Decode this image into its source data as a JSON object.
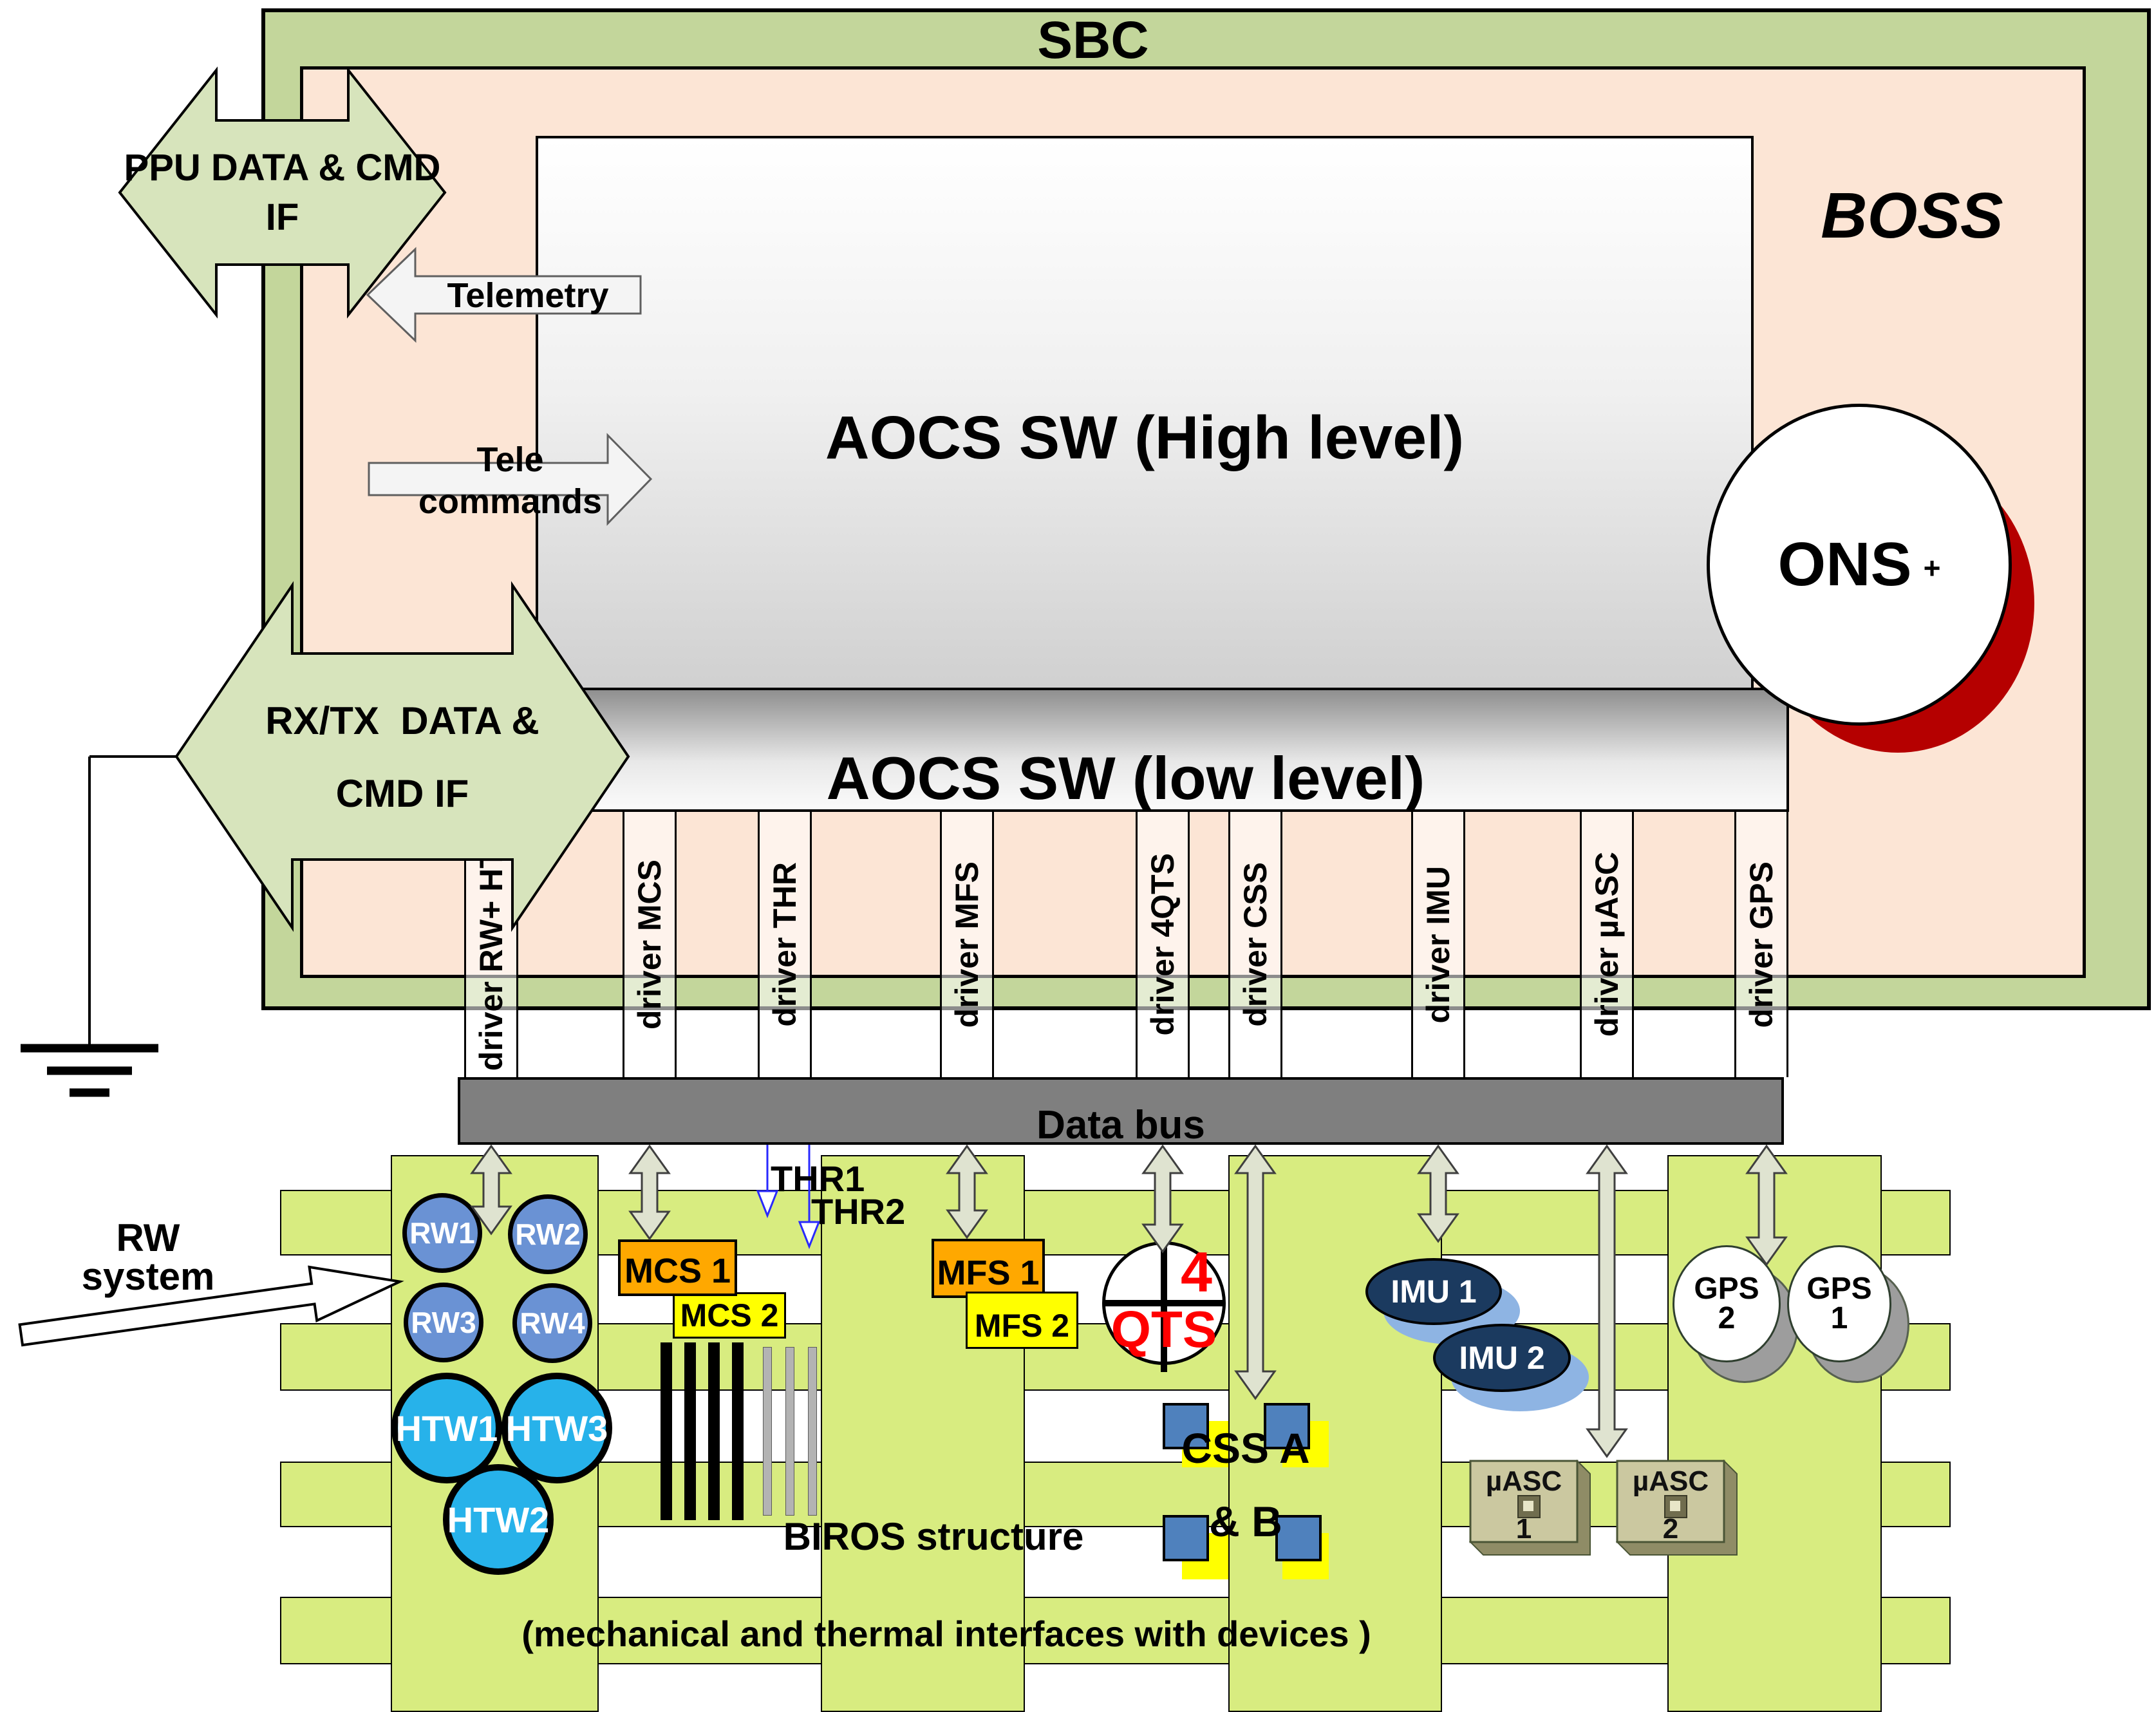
{
  "titles": {
    "sbc": "SBC",
    "boss": "BOSS"
  },
  "software": {
    "high_level": "AOCS SW (High level)",
    "low_level": "AOCS SW (low level)",
    "ons": "ONS",
    "ons_plus": "+"
  },
  "drivers": [
    {
      "label": "driver RW+ HTW"
    },
    {
      "label": "driver MCS"
    },
    {
      "label": "driver THR"
    },
    {
      "label": "driver MFS"
    },
    {
      "label": "driver 4QTS"
    },
    {
      "label": "driver CSS"
    },
    {
      "label": "driver IMU"
    },
    {
      "label": "driver µASC"
    },
    {
      "label": "driver GPS"
    }
  ],
  "bus": {
    "label": "Data bus"
  },
  "interfaces": {
    "ppu": {
      "line1": "PPU DATA & CMD",
      "line2": "IF"
    },
    "telemetry": {
      "label": "Telemetry"
    },
    "telecommands": {
      "line1": "Tele",
      "line2": "commands"
    },
    "rxtx": {
      "line1": "RX/TX  DATA &",
      "line2": "CMD IF"
    }
  },
  "thrusters": {
    "thr1": "THR1",
    "thr2": "THR2"
  },
  "devices": {
    "rw": [
      "RW1",
      "RW2",
      "RW3",
      "RW4"
    ],
    "htw": [
      "HTW1",
      "HTW3",
      "HTW2"
    ],
    "mcs1": "MCS 1",
    "mcs2": "MCS 2",
    "mfs1": "MFS 1",
    "mfs2": "MFS 2",
    "qts": {
      "num": "4",
      "label": "QTS"
    },
    "css": {
      "line1": "CSS A",
      "line2": "& B"
    },
    "imu1": "IMU 1",
    "imu2": "IMU 2",
    "uasc1": {
      "name": "µASC",
      "num": "1"
    },
    "uasc2": {
      "name": "µASC",
      "num": "2"
    },
    "gps2": {
      "line1": "GPS",
      "line2": "2"
    },
    "gps1": {
      "line1": "GPS",
      "line2": "1"
    }
  },
  "structure": {
    "rw_system_line1": "RW",
    "rw_system_line2": "system",
    "biros": "BIROS structure",
    "mech": "(mechanical and thermal interfaces with devices )"
  },
  "colors": {
    "sbc_green": "#c3d69b",
    "boss_peach": "#fce5d5",
    "lattice_green": "#d8ec80",
    "bus_gray": "#7f7f7f",
    "orange": "#ffa800",
    "yellow": "#ffff00",
    "rw_blue": "#6a92d4",
    "htw_cyan": "#27b2ea",
    "imu_navy": "#1b3a5f",
    "imu_shadow": "#8eb4e3",
    "css_blue": "#4f81bd",
    "ons_shadow_red": "#b50000",
    "qts_red": "#ff0000",
    "arrow_green": "#d7e4bc",
    "device_arrow": "#dfe3d0",
    "uasc_khaki": "#cbc8a0",
    "thr_blue": "#2929ff"
  }
}
